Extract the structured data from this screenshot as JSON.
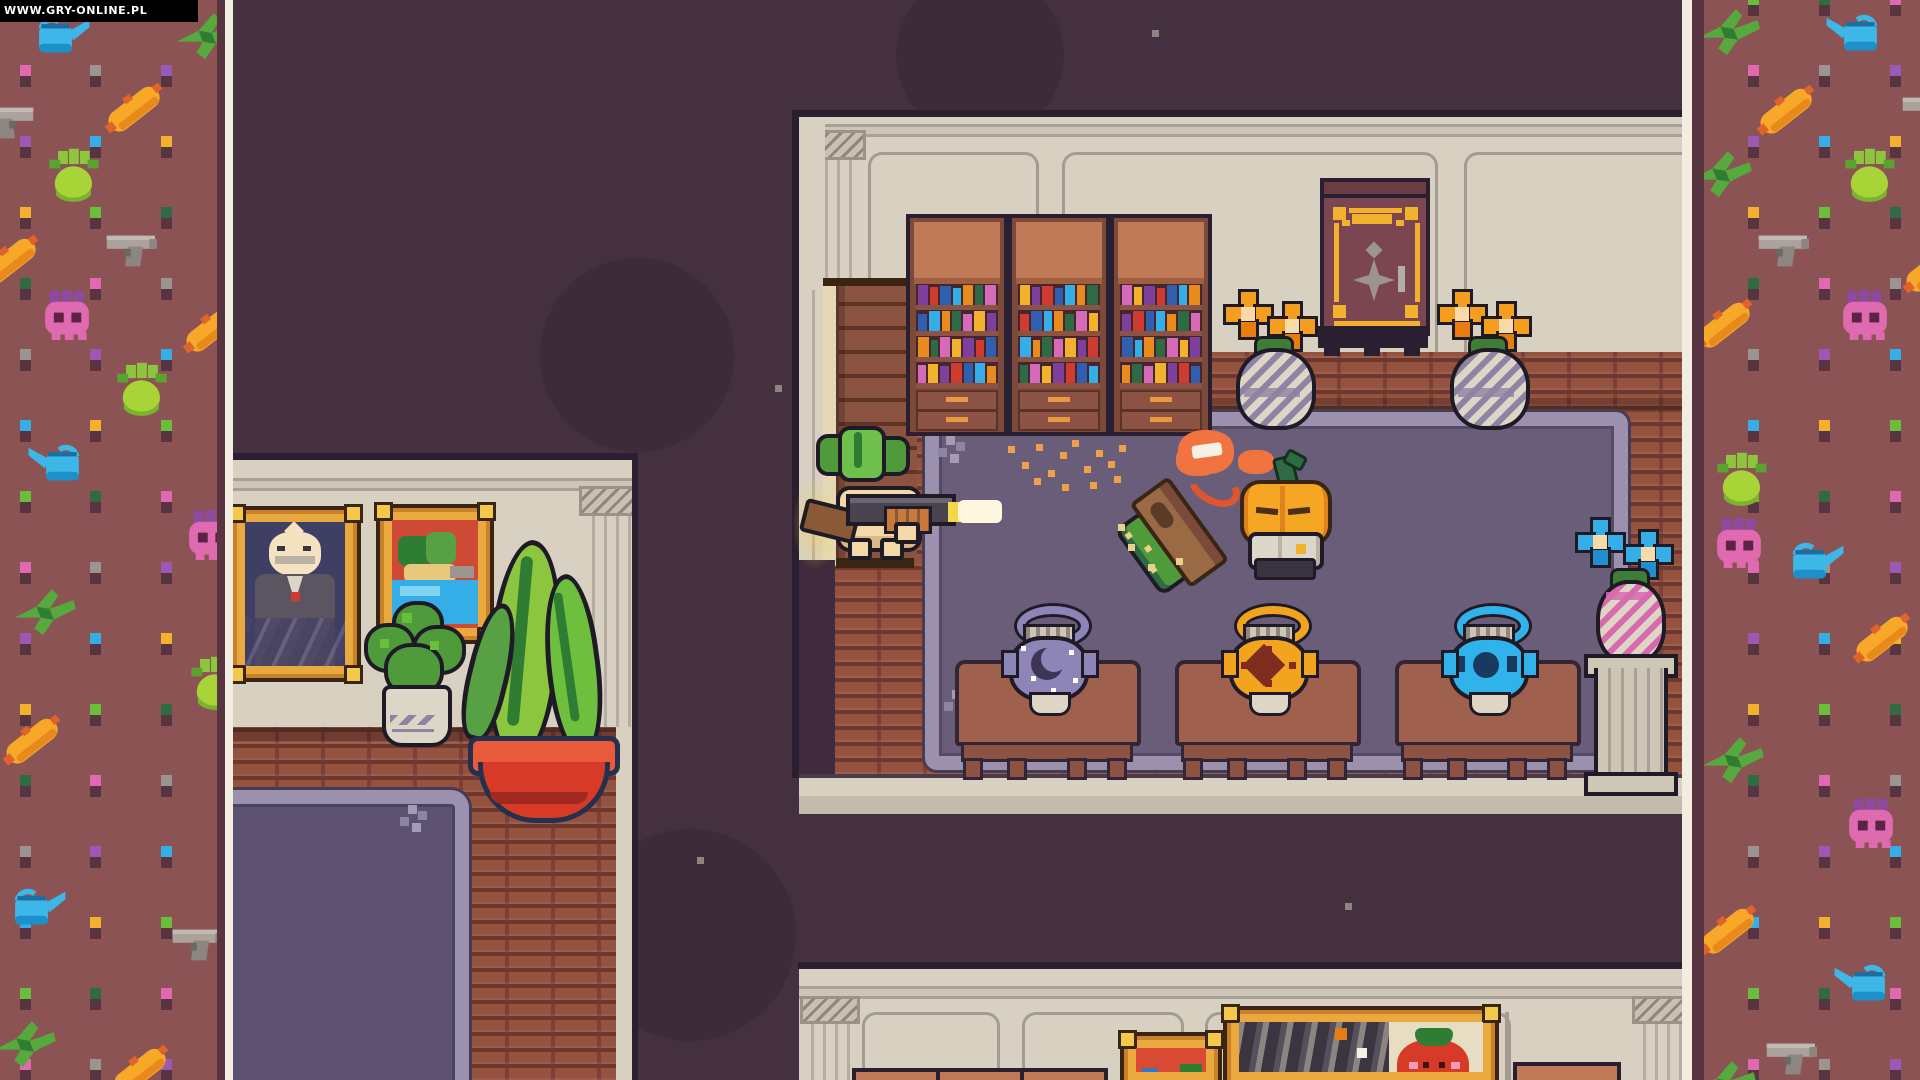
{
  "watermark": {
    "text": "WWW.GRY-ONLINE.PL"
  },
  "scene": {
    "description": "top-down pixel-art mansion library scene",
    "entities": [
      "turnip-boy-player",
      "pump-shotgun",
      "muzzle-flash",
      "shell-glow",
      "pumpkin-citizen-npc",
      "fallen-signpost-enemy",
      "hit-poof",
      "library-bookcases",
      "wall-safe",
      "flower-vases",
      "urns-on-chairs",
      "pedestal-with-blue-flowers",
      "onion-portrait-painting",
      "landscape-painting",
      "strawberry-painting",
      "abstract-painting",
      "bush-houseplant",
      "swirl-houseplant-red-pot"
    ]
  },
  "palette": {
    "void": "#44303f",
    "border_bg": "#8b5354",
    "border_dark": "#57343f",
    "divider": "#f2ece1",
    "wall": "#d8d1c2",
    "wall_line": "#a9a199",
    "outline": "#2a1f30",
    "brick": "#95523f",
    "rug_field": "#695d79",
    "rug_border": "#9b90ae",
    "rug_left_field": "#5c5170",
    "wood": "#7c4a3b",
    "wood_light": "#c07a58",
    "gold": "#f2b22e",
    "leaf_green": "#4f9a3a",
    "turnip_skin": "#f4d9a8",
    "pumpkin_orange": "#f5a623",
    "flash": "#fff7e0",
    "pot_purple": "#8d84b8",
    "pot_gold": "#f2a41f",
    "pot_blue": "#2fb3ea",
    "flower_orange": "#f59d1f",
    "flower_blue": "#35aee8",
    "red_pot": "#d83a28",
    "strawberry": "#d83a28"
  },
  "borders": {
    "square_colors": [
      "#6abf3a",
      "#9c9491",
      "#f2b22e",
      "#e06ab0",
      "#35aee8",
      "#2e6b45",
      "#9b59b6"
    ],
    "square_shadow": "#57343f",
    "grid": {
      "rows": 16,
      "y0": -6,
      "step": 71,
      "left_cols": [
        20,
        90,
        161
      ],
      "right_cols": [
        1748,
        1819,
        1890
      ]
    },
    "left_icons": [
      {
        "t": "can",
        "x": 26,
        "y": 8,
        "f": 0
      },
      {
        "t": "bird",
        "x": 170,
        "y": 8,
        "f": 0
      },
      {
        "t": "carrot",
        "x": 98,
        "y": 80,
        "f": 0
      },
      {
        "t": "gun",
        "x": -28,
        "y": 96,
        "f": 1
      },
      {
        "t": "turnip",
        "x": 34,
        "y": 148,
        "f": 0
      },
      {
        "t": "gun",
        "x": 98,
        "y": 224,
        "f": 0
      },
      {
        "t": "carrot",
        "x": -26,
        "y": 232,
        "f": 0
      },
      {
        "t": "skull",
        "x": 32,
        "y": 290,
        "f": 0
      },
      {
        "t": "carrot",
        "x": 176,
        "y": 300,
        "f": 0
      },
      {
        "t": "turnip",
        "x": 102,
        "y": 362,
        "f": 0
      },
      {
        "t": "can",
        "x": 22,
        "y": 436,
        "f": 1
      },
      {
        "t": "skull",
        "x": 176,
        "y": 510,
        "f": 0
      },
      {
        "t": "bird",
        "x": 8,
        "y": 584,
        "f": 0
      },
      {
        "t": "turnip",
        "x": 176,
        "y": 656,
        "f": 0
      },
      {
        "t": "carrot",
        "x": -4,
        "y": 712,
        "f": 0
      },
      {
        "t": "can",
        "x": 2,
        "y": 880,
        "f": 0
      },
      {
        "t": "gun",
        "x": 164,
        "y": 918,
        "f": 0
      },
      {
        "t": "bird",
        "x": -12,
        "y": 1016,
        "f": 0
      },
      {
        "t": "carrot",
        "x": 104,
        "y": 1042,
        "f": 0
      }
    ],
    "right_icons": [
      {
        "t": "bird",
        "x": 1692,
        "y": 4,
        "f": 0
      },
      {
        "t": "can",
        "x": 1820,
        "y": 6,
        "f": 1
      },
      {
        "t": "carrot",
        "x": 1750,
        "y": 82,
        "f": 0
      },
      {
        "t": "gun",
        "x": 1894,
        "y": 86,
        "f": 0
      },
      {
        "t": "bird",
        "x": 1684,
        "y": 146,
        "f": 0
      },
      {
        "t": "turnip",
        "x": 1830,
        "y": 148,
        "f": 0
      },
      {
        "t": "gun",
        "x": 1750,
        "y": 224,
        "f": 0
      },
      {
        "t": "carrot",
        "x": 1896,
        "y": 240,
        "f": 0
      },
      {
        "t": "carrot",
        "x": 1688,
        "y": 296,
        "f": 0
      },
      {
        "t": "skull",
        "x": 1830,
        "y": 290,
        "f": 0
      },
      {
        "t": "turnip",
        "x": 1702,
        "y": 452,
        "f": 0
      },
      {
        "t": "skull",
        "x": 1704,
        "y": 518,
        "f": 0
      },
      {
        "t": "can",
        "x": 1780,
        "y": 534,
        "f": 0
      },
      {
        "t": "carrot",
        "x": 1846,
        "y": 610,
        "f": 0
      },
      {
        "t": "bird",
        "x": 1696,
        "y": 732,
        "f": 0
      },
      {
        "t": "skull",
        "x": 1836,
        "y": 798,
        "f": 0
      },
      {
        "t": "carrot",
        "x": 1692,
        "y": 902,
        "f": 0
      },
      {
        "t": "can",
        "x": 1828,
        "y": 956,
        "f": 1
      },
      {
        "t": "gun",
        "x": 1758,
        "y": 1032,
        "f": 0
      },
      {
        "t": "bird",
        "x": 1688,
        "y": 1056,
        "f": 0
      }
    ]
  },
  "bookcases": {
    "x": [
      906,
      1008,
      1110
    ],
    "y": 214,
    "w": 94,
    "h": 214,
    "book_colors": [
      "#7e3f9d",
      "#2e6b45",
      "#2f5fae",
      "#f2b22e",
      "#e88b1f",
      "#cf3b2f",
      "#d46ab8",
      "#35aee8"
    ],
    "book_widths": [
      10,
      9,
      11,
      8,
      10,
      9,
      11,
      9
    ],
    "book_heights": [
      20,
      17,
      20,
      18,
      20,
      17,
      19,
      20
    ]
  },
  "particles": {
    "color": "#f0a04a",
    "points": [
      [
        1008,
        446
      ],
      [
        1022,
        462
      ],
      [
        1036,
        444
      ],
      [
        1048,
        470
      ],
      [
        1060,
        452
      ],
      [
        1072,
        440
      ],
      [
        1084,
        466
      ],
      [
        1096,
        450
      ],
      [
        1108,
        461
      ],
      [
        1119,
        445
      ],
      [
        1062,
        484
      ],
      [
        1034,
        478
      ],
      [
        1090,
        482
      ],
      [
        1114,
        476
      ]
    ]
  },
  "dust": {
    "color": "#8a8580",
    "points": [
      [
        775,
        385
      ],
      [
        1152,
        30
      ],
      [
        697,
        857
      ],
      [
        1345,
        903
      ],
      [
        622,
        700
      ]
    ]
  },
  "blobs": [
    [
      637,
      355,
      110
    ],
    [
      690,
      935,
      120
    ],
    [
      980,
      55,
      95
    ]
  ]
}
